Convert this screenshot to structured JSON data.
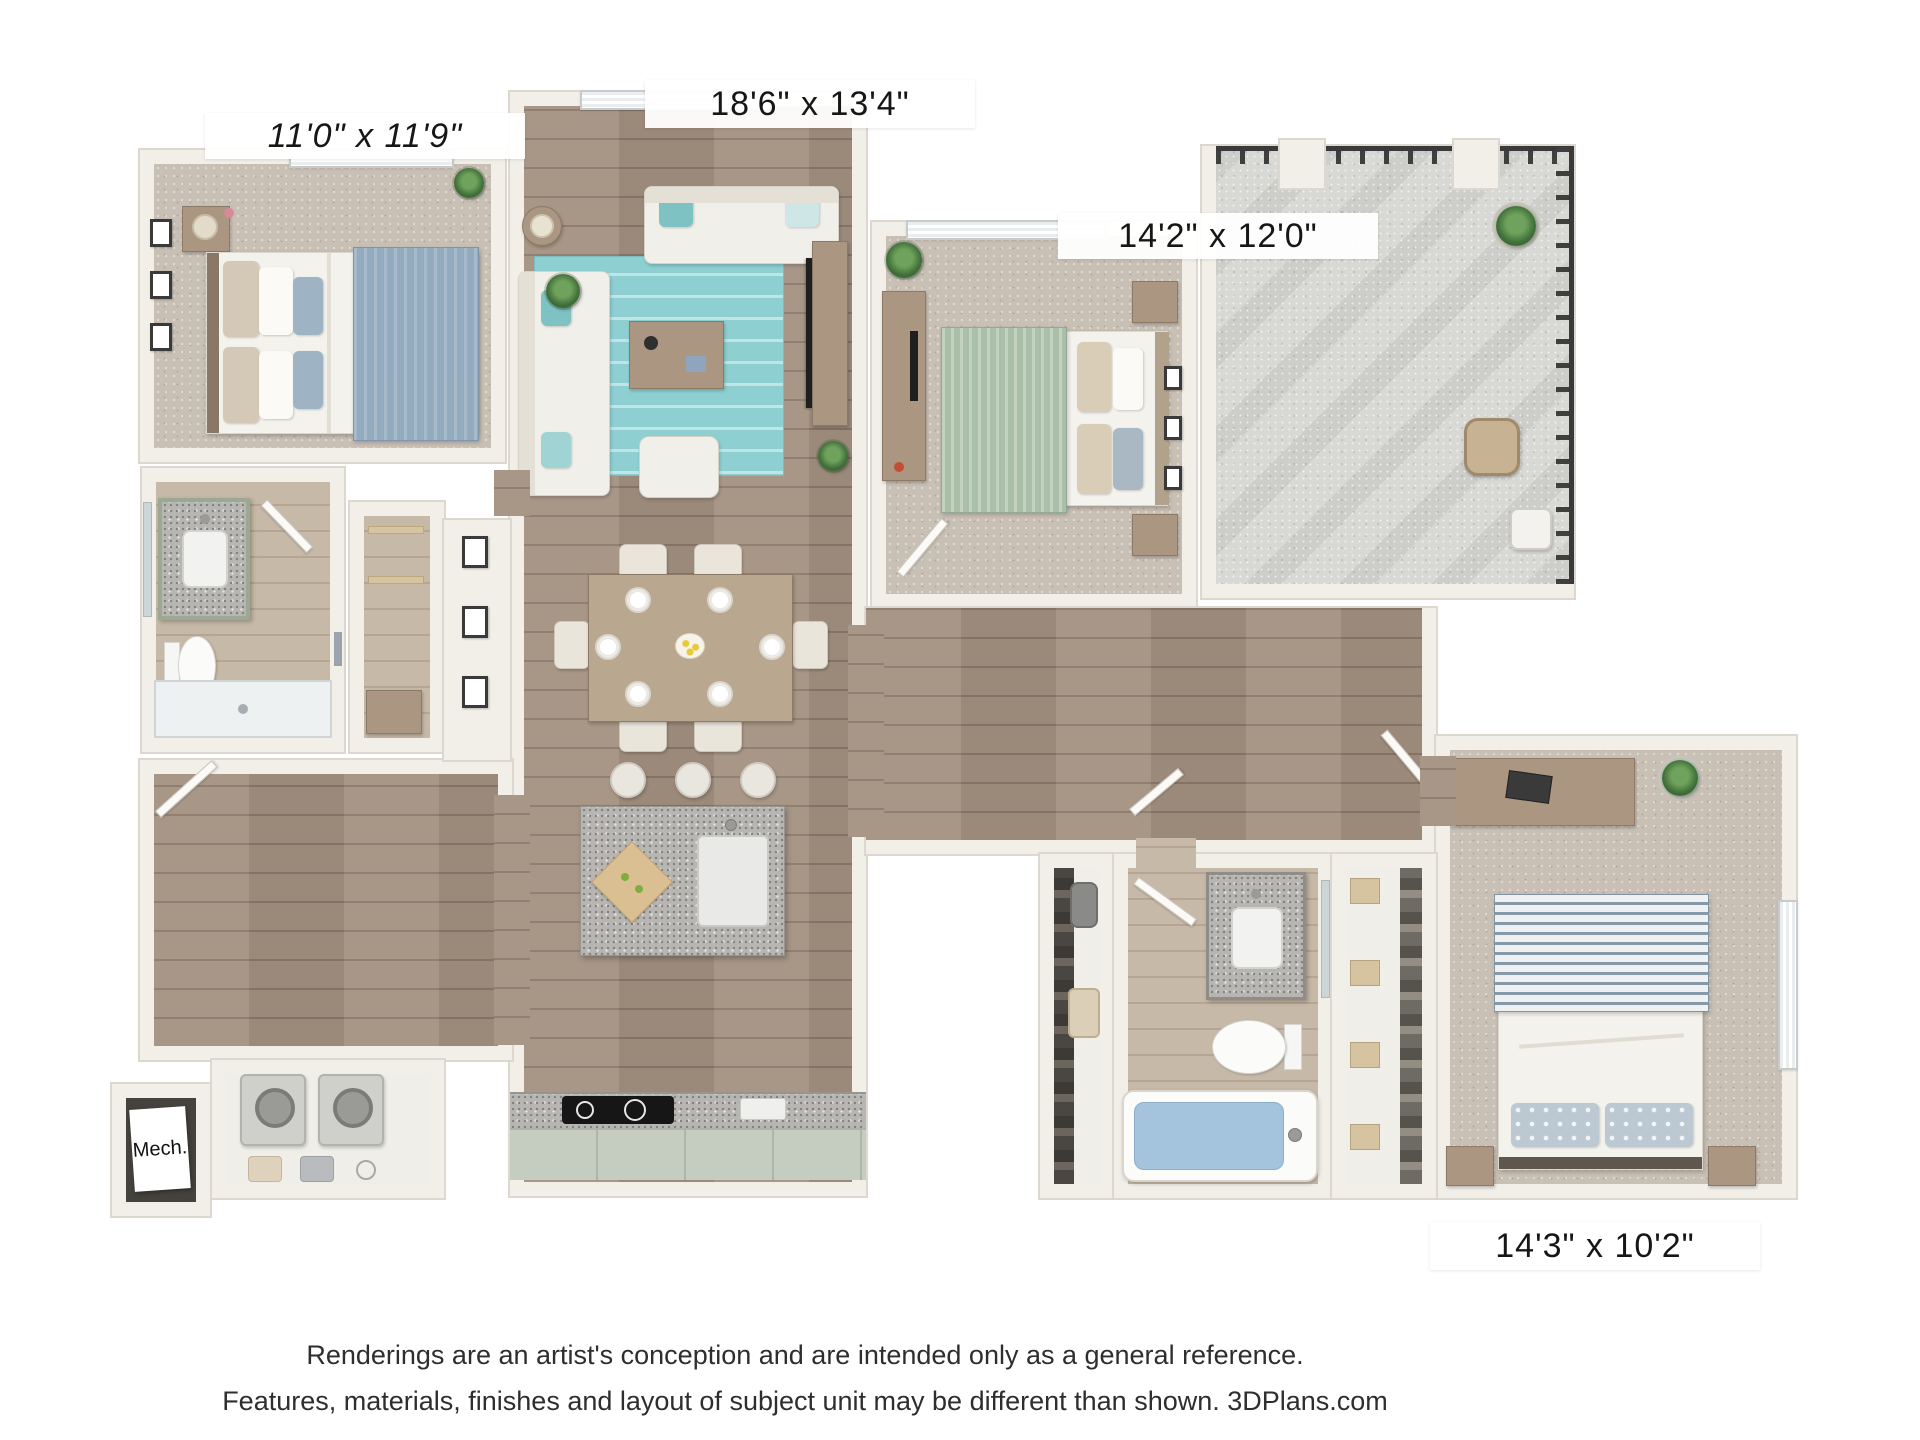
{
  "labels": {
    "bedroom1_dim": "11'0\" x 11'9\"",
    "living_dim": "18'6\" x 13'4\"",
    "bedroom2_dim": "14'2\" x 12'0\"",
    "bedroom3_dim": "14'3\" x 10'2\"",
    "mech": "Mech."
  },
  "footer": {
    "line1": "Renderings are an artist's conception and are intended only as a general reference.",
    "line2": "Features, materials, finishes and layout of subject unit may be different than shown. 3DPlans.com"
  },
  "palette": {
    "background": "#ffffff",
    "wall": "#f2efe9",
    "wall_edge": "#dcd8d0",
    "wood_floor": "#a39181",
    "light_wood_floor": "#c7b9a7",
    "carpet": "#c9c0b5",
    "concrete": "#d8d8d5",
    "accent_teal_rug": "#8ed0d1",
    "bed_blue_blanket": "#93abbf",
    "bed_green_blanket": "#aabfa7",
    "bed_stripe_blue": "#8699a8",
    "granite": "#b8b6b3",
    "cabinet_green": "#9aa894",
    "railing": "#3f3f3f",
    "tub_water": "#a3c4dc",
    "plant_green": "#4e8045",
    "label_text": "#161616",
    "footer_text": "#2e2e2e"
  }
}
